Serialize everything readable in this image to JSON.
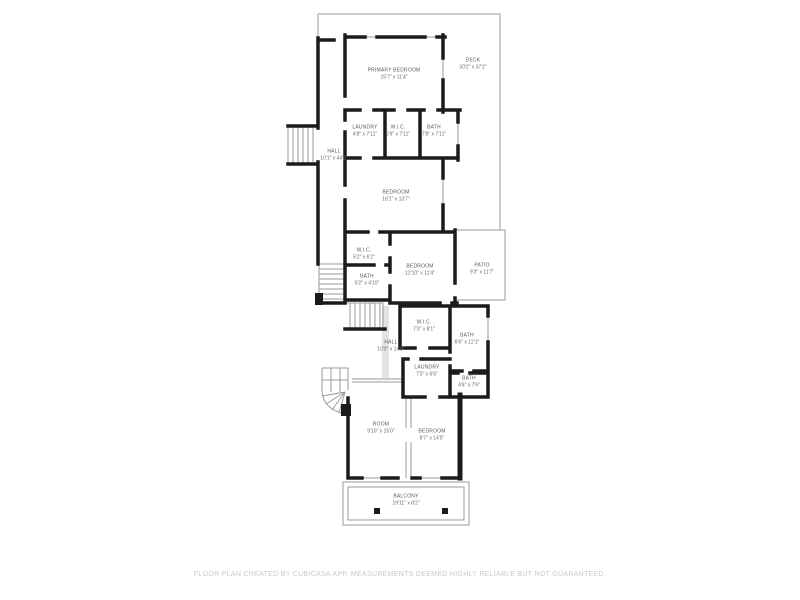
{
  "title": "Floor plan",
  "colors": {
    "wall": "#1b1b1b",
    "thin_line": "#9a9a9a",
    "label_text": "#5a5a5a",
    "footer_text": "#c9c9c9",
    "background": "#ffffff"
  },
  "rooms": [
    {
      "name": "PRIMARY BEDROOM",
      "dims": "15'7\" x 11'4\""
    },
    {
      "name": "DECK",
      "dims": "30'2\" x 37'2\""
    },
    {
      "name": "LAUNDRY",
      "dims": "4'8\" x 7'11\""
    },
    {
      "name": "W.I.C.",
      "dims": "5'9\" x 7'11\""
    },
    {
      "name": "BATH",
      "dims": "7'8\" x 7'11\""
    },
    {
      "name": "HALL",
      "dims": "10'1\" x 44'2\""
    },
    {
      "name": "BEDROOM",
      "dims": "16'1\" x 13'7\""
    },
    {
      "name": "W.I.C.",
      "dims": "5'2\" x 6'2\""
    },
    {
      "name": "BATH",
      "dims": "5'2\" x 4'10\""
    },
    {
      "name": "BEDROOM",
      "dims": "12'10\" x 11'4\""
    },
    {
      "name": "PATIO",
      "dims": "9'3\" x 11'7\""
    },
    {
      "name": "W.I.C.",
      "dims": "7'3\" x 8'1\""
    },
    {
      "name": "BATH",
      "dims": "6'6\" x 12'1\""
    },
    {
      "name": "HALL",
      "dims": "10'0\" x 14'9\""
    },
    {
      "name": "LAUNDRY",
      "dims": "7'3\" x 6'6\""
    },
    {
      "name": "BATH",
      "dims": "4'6\" x 7'6\""
    },
    {
      "name": "ROOM",
      "dims": "9'10\" x 15'0\""
    },
    {
      "name": "BEDROOM",
      "dims": "8'7\" x 14'5\""
    },
    {
      "name": "BALCONY",
      "dims": "19'11\" x 8'2\""
    }
  ],
  "footer": {
    "disclaimer": "FLOOR PLAN CREATED BY CUBICASA APP. MEASUREMENTS DEEMED HIGHLY RELIABLE BUT NOT GUARANTEED."
  }
}
